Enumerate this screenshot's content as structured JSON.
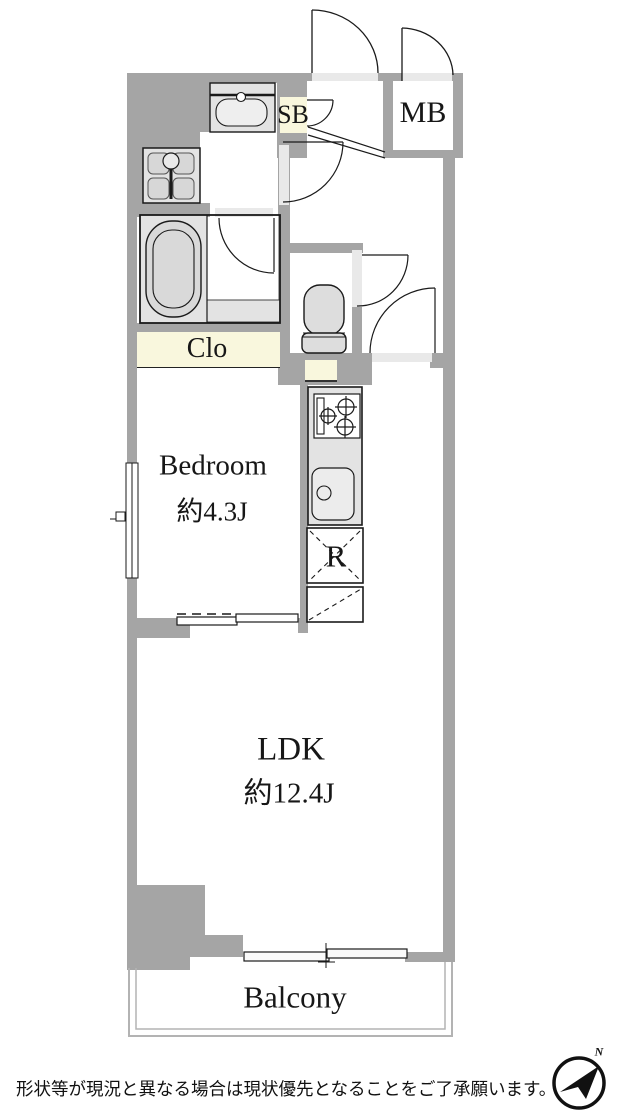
{
  "plan": {
    "labels": {
      "shoe_box": "SB",
      "meter_box": "MB",
      "closet": "Clo",
      "bedroom_name": "Bedroom",
      "bedroom_size": "約4.3J",
      "ldk_name": "LDK",
      "ldk_size": "約12.4J",
      "refrigerator": "R",
      "balcony": "Balcony"
    },
    "colors": {
      "wall": "#a5a5a5",
      "door_opening": "#e9e9e9",
      "cabinet_cream": "#f9f7dd",
      "fixture_gray": "#e3e3e3",
      "line": "#1a1a1a"
    }
  },
  "compass": {
    "north_label": "N"
  },
  "footer": {
    "note": "形状等が現況と異なる場合は現状優先となることをご了承願います。"
  }
}
